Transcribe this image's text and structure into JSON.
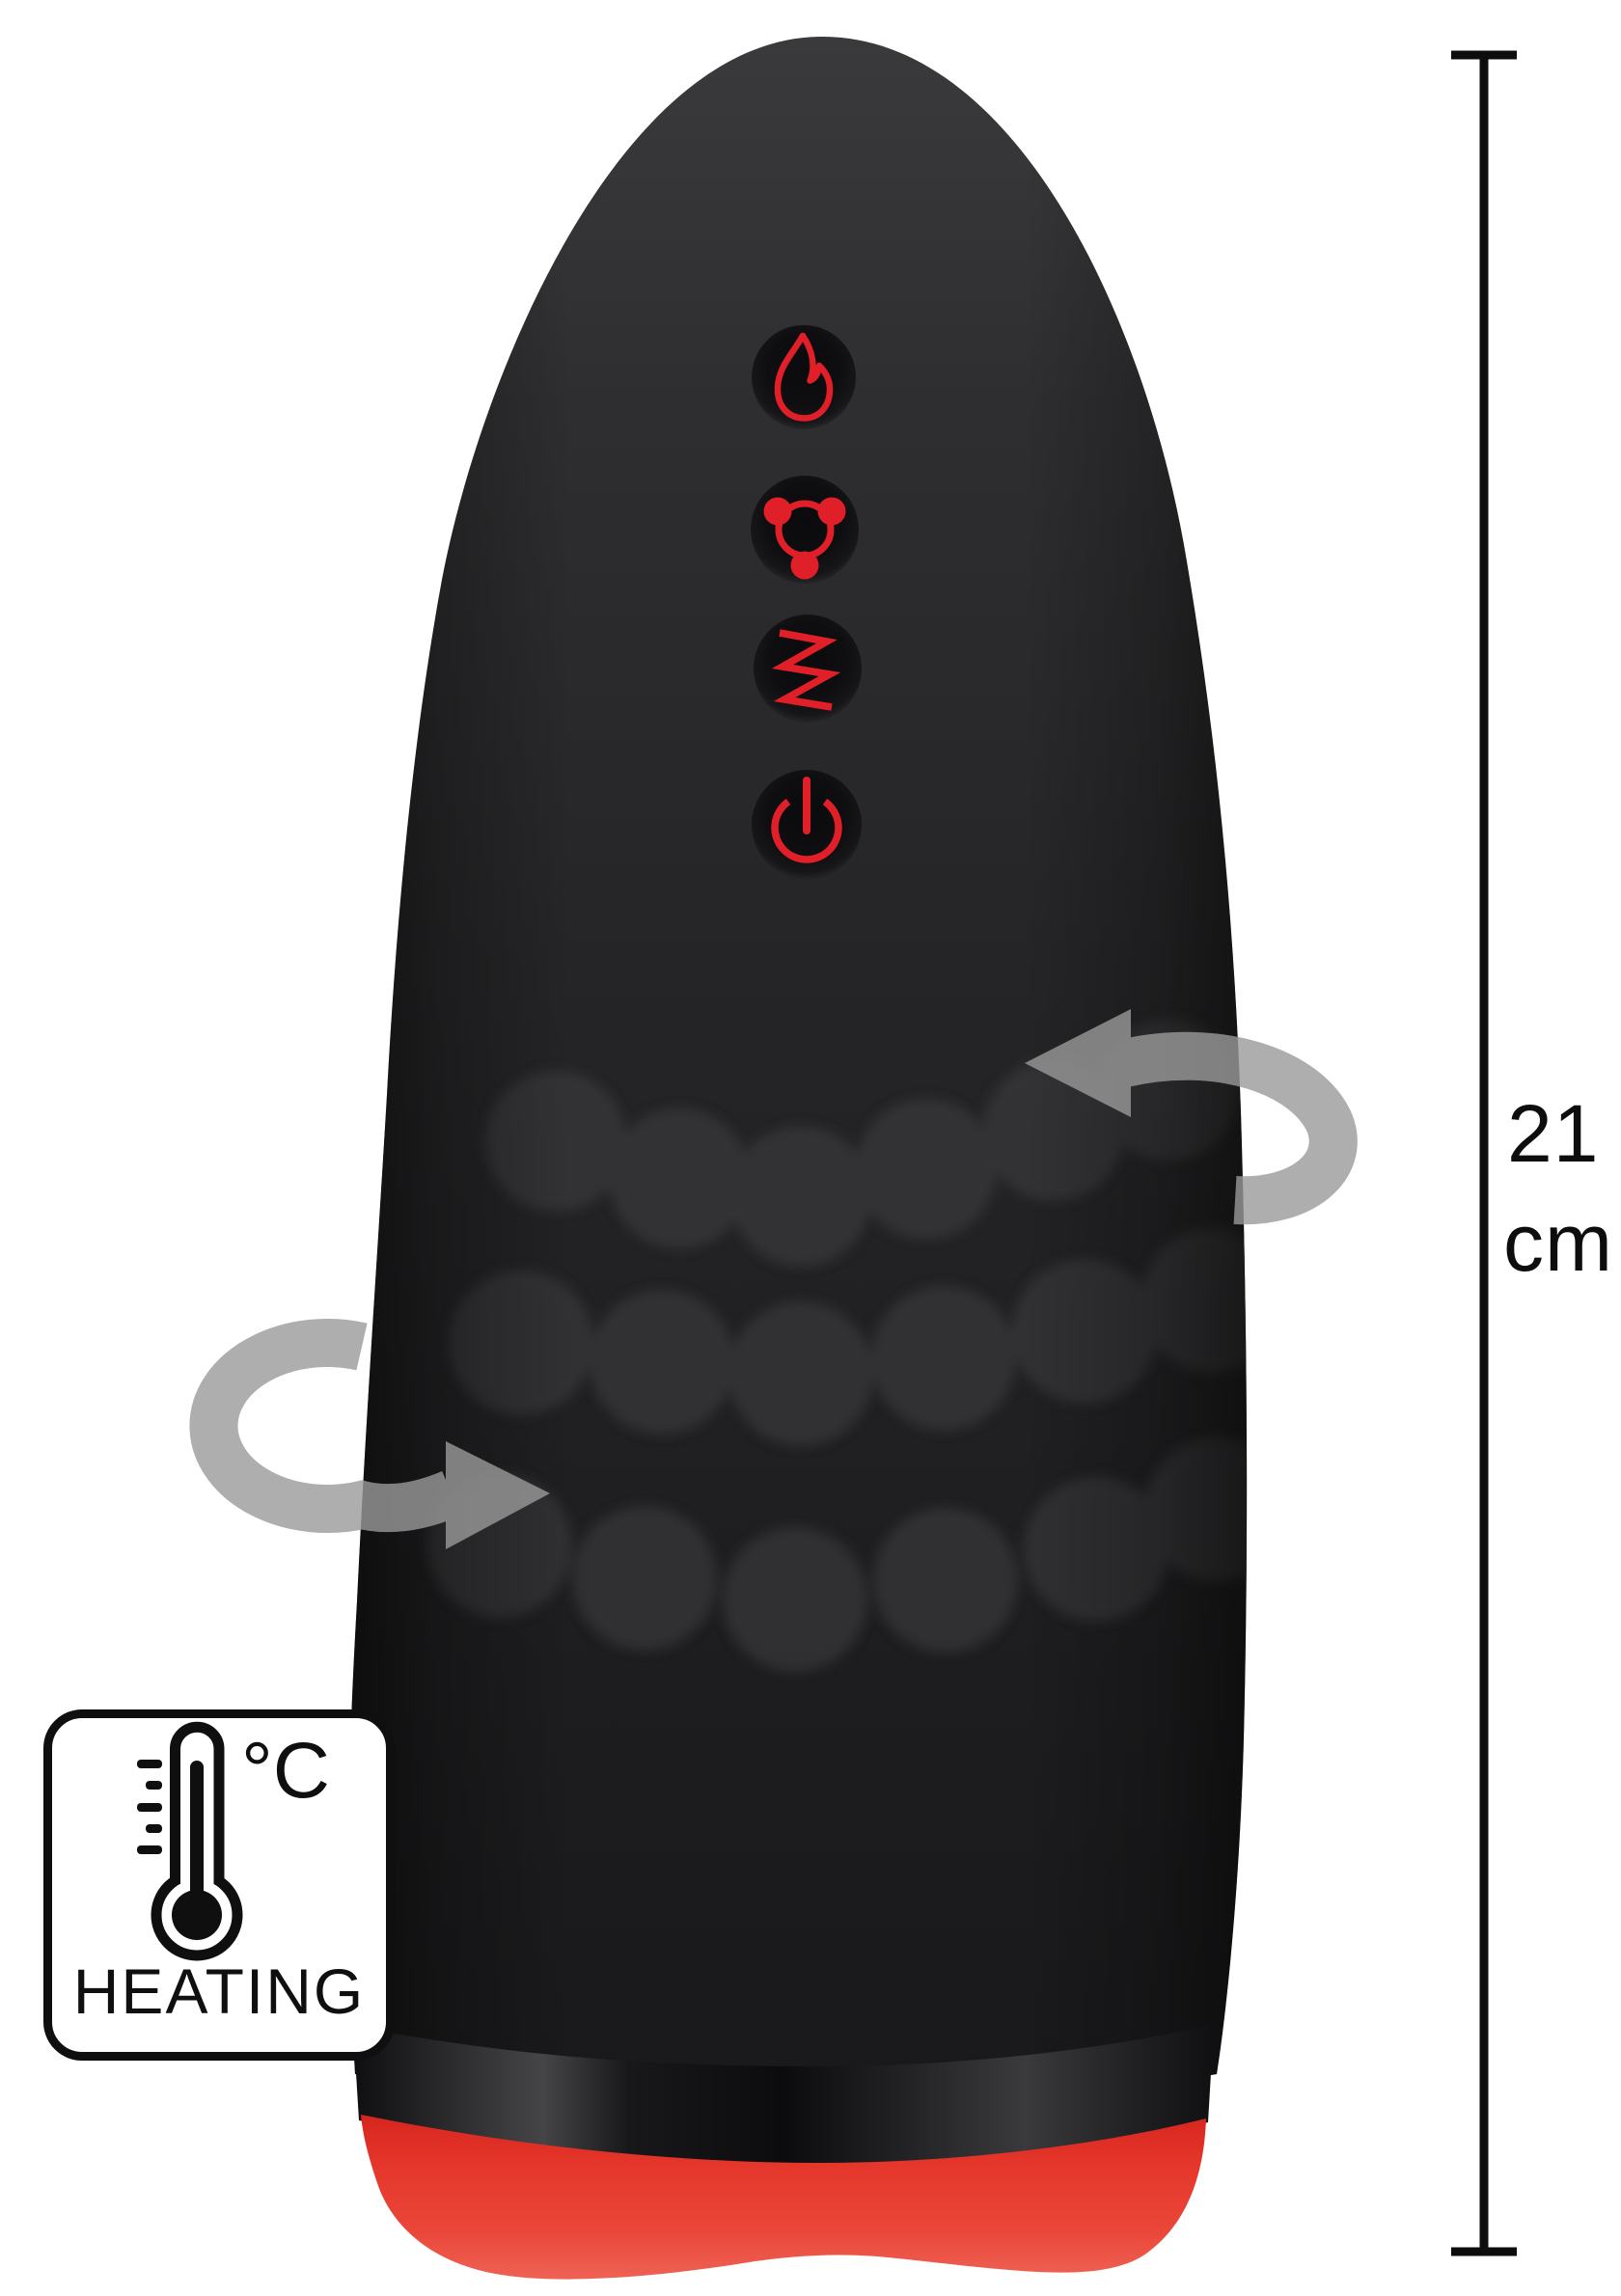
{
  "background_color": "#ffffff",
  "device": {
    "body_color": "#232325",
    "base_color": "#e5362b",
    "button_icon_color": "#e11f29",
    "arrow_color": "#9a9a9a",
    "buttons": [
      {
        "icon": "flame-icon"
      },
      {
        "icon": "rotation-icon"
      },
      {
        "icon": "vibration-icon"
      },
      {
        "icon": "power-icon"
      }
    ],
    "rotation_arrows": [
      {
        "icon": "rotate-arrow-right-icon"
      },
      {
        "icon": "rotate-arrow-left-icon"
      }
    ]
  },
  "measurement": {
    "value": "21",
    "unit": "cm",
    "line_color": "#0d0d0d"
  },
  "heating_badge": {
    "temperature_unit": "°C",
    "label": "HEATING"
  }
}
